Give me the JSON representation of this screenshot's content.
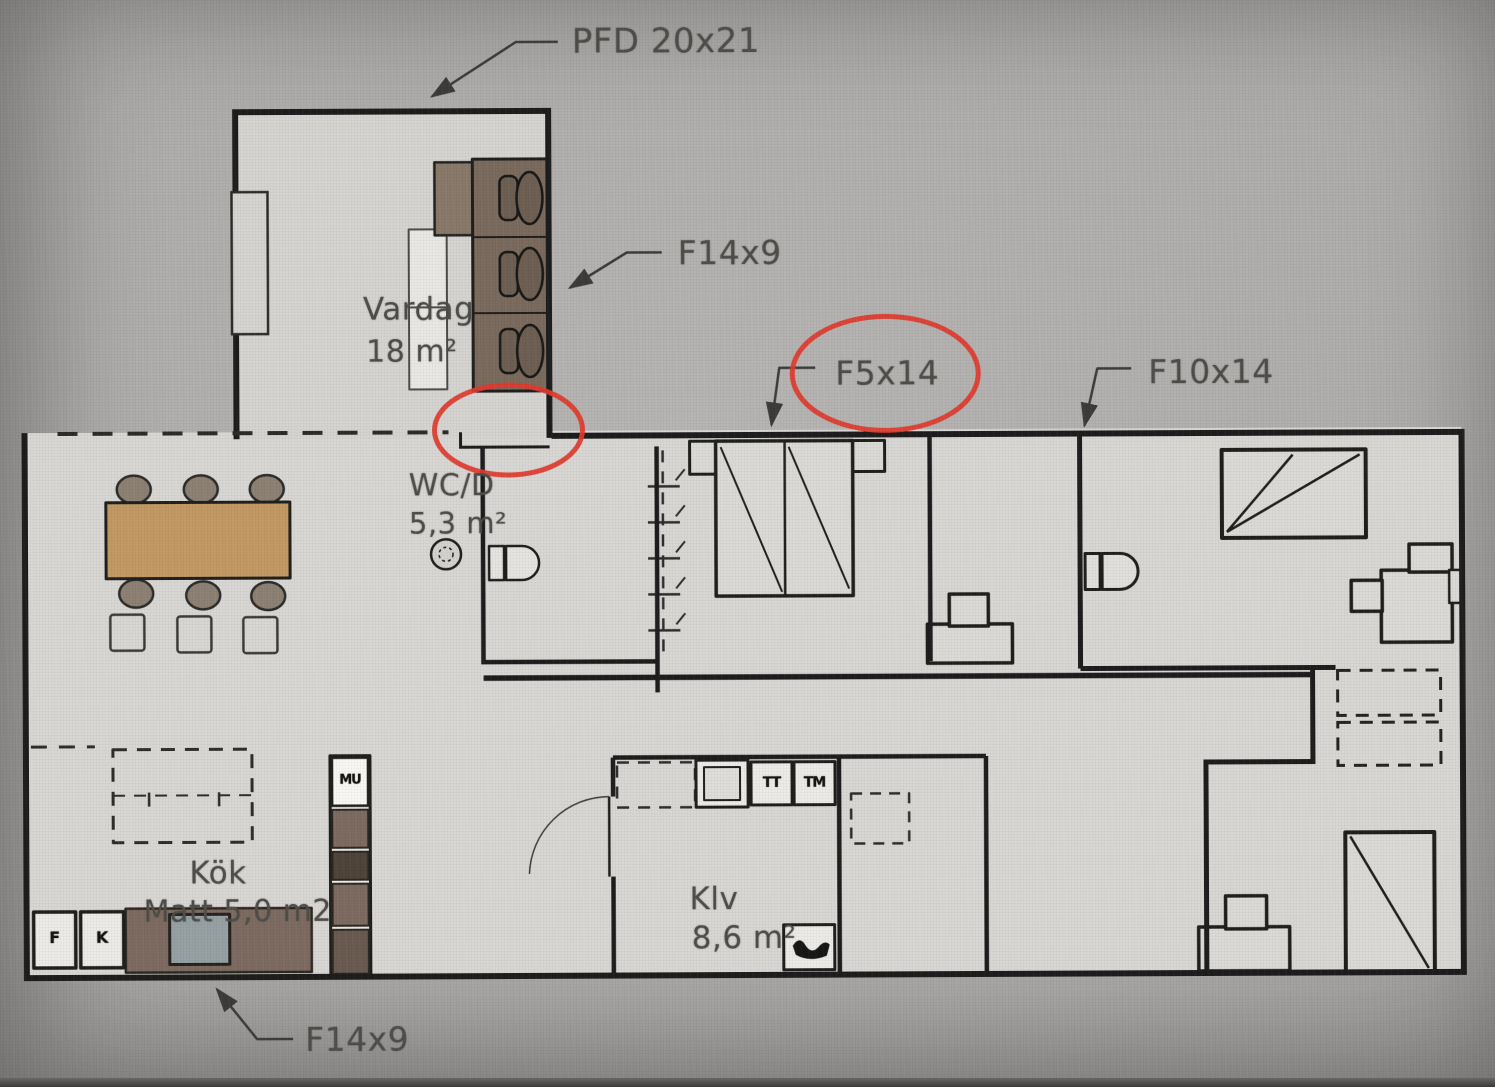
{
  "plan": {
    "labels": {
      "pfd": "PFD 20x21",
      "f14x9_top": "F14x9",
      "f5x14": "F5x14",
      "f10x14": "F10x14",
      "f14x9_bottom": "F14x9"
    },
    "rooms": {
      "living": {
        "name": "Vardag",
        "area": "18 m²"
      },
      "wc": {
        "name": "WC/D",
        "area": "5,3 m²"
      },
      "kitchen": {
        "name": "Kök",
        "area_line": "Matt 5,0 m2"
      },
      "laundry": {
        "name": "Klv",
        "area": "8,6 m²"
      }
    },
    "appliances": {
      "freezer": "F",
      "fridge": "K",
      "microwave": "MU",
      "dryer": "TT",
      "washer": "TM"
    },
    "colors": {
      "annotation_red": "#e23a2d",
      "wall": "#1b1b1b",
      "floor": "#dbd9d6",
      "photo_background": "#aaa8a6",
      "sofa_brown": "#7b6a5d",
      "table_wood": "#c49a62",
      "counter_brown": "#7d6b60",
      "sink_gray": "#97a2a4"
    }
  }
}
